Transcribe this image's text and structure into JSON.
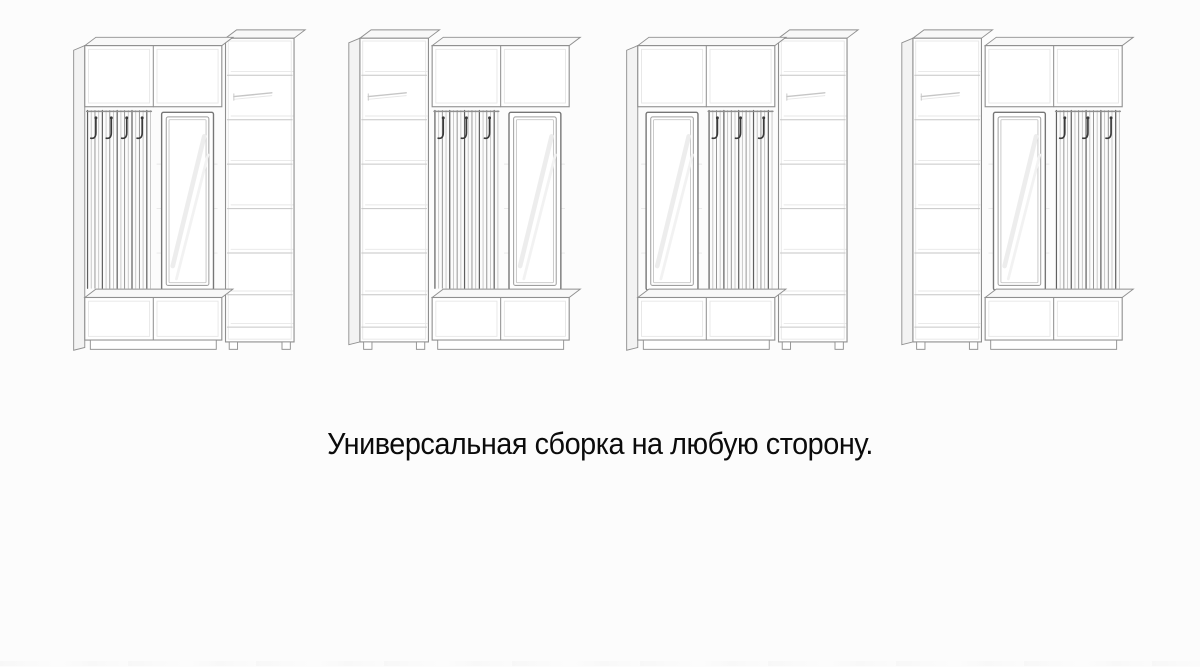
{
  "page": {
    "background": "#fcfcfc",
    "caption": "Универсальная сборка на любую сторону."
  },
  "diagram": {
    "colors": {
      "line": "#8f8f8f",
      "light": "#c6c6c6",
      "faint": "#e7e7e7",
      "dark": "#5f5f5f",
      "hook": "#3a3a3a",
      "frame": "#767676",
      "face": "#f8f8f8",
      "side": "#f3f3f3"
    },
    "units": [
      {
        "name": "hooks-mirror-shelf",
        "column_side": "right",
        "module_order": [
          "hooks",
          "mirror"
        ],
        "hook_count": 4
      },
      {
        "name": "shelf-hooks-mirror",
        "column_side": "left",
        "module_order": [
          "hooks",
          "mirror"
        ],
        "hook_count": 3
      },
      {
        "name": "mirror-hooks-shelf",
        "column_side": "right",
        "module_order": [
          "mirror",
          "hooks"
        ],
        "hook_count": 3
      },
      {
        "name": "shelf-mirror-hooks",
        "column_side": "left",
        "module_order": [
          "mirror",
          "hooks"
        ],
        "hook_count": 3
      }
    ]
  }
}
